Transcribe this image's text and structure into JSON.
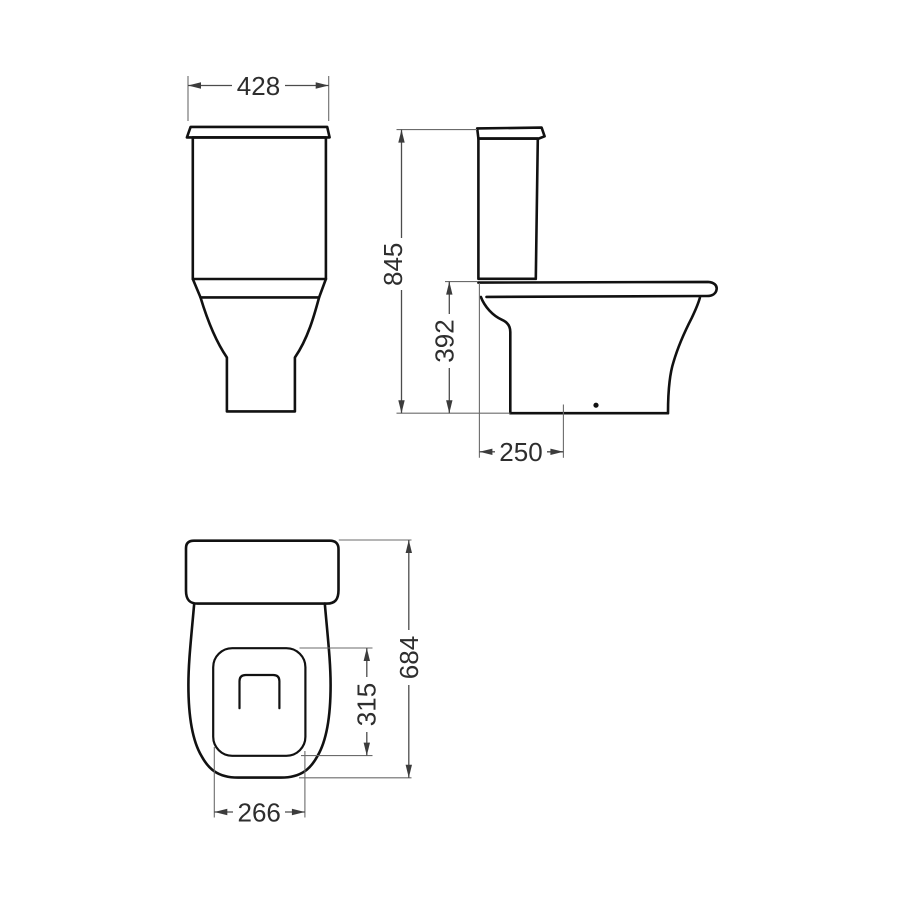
{
  "dimensions": {
    "front_width": "428",
    "overall_height": "845",
    "bowl_height": "392",
    "outlet_distance": "250",
    "overall_depth": "684",
    "opening_depth": "315",
    "opening_width": "266"
  },
  "style": {
    "background": "#ffffff",
    "object_line_color": "#111111",
    "dimension_line_color": "#4c4c4c",
    "label_color": "#2e2e2e"
  }
}
